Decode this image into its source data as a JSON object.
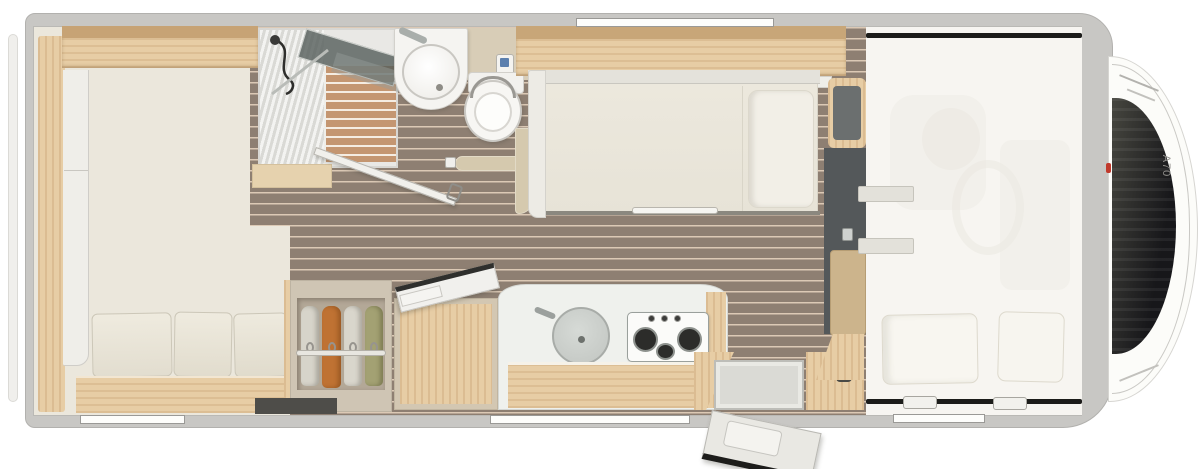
{
  "meta": {
    "title": "Motorhome floor plan, top view",
    "model_label": "A70"
  },
  "palette": {
    "background": "#ffffff",
    "wall_gray": "#c8c7c4",
    "floor_wood": "#8e7f72",
    "floor_cream": "#ebe7dc",
    "furniture_oak": "#e7cda5",
    "upholstery_cream": "#f1eee6",
    "accent_dark": "#1d1d1b",
    "dinette_slate": "#54585a",
    "clothes_orange": "#bf7233",
    "clothes_green": "#a3a173",
    "marker_red": "#c13a2c",
    "panel_screen_blue": "#5b7fae"
  },
  "rooms": {
    "rear_bedroom": {
      "name": "rear bedroom",
      "fixtures": [
        "side wardrobe",
        "overhead cabinet",
        "bed with three cushions"
      ]
    },
    "bathroom": {
      "name": "bathroom",
      "fixtures": [
        "shower cabin",
        "washbasin",
        "toilet",
        "open swing door",
        "partition wall"
      ]
    },
    "kitchen": {
      "name": "kitchen",
      "fixtures": [
        "hanging wardrobe with clothes",
        "fridge cabinet with open lid",
        "round sink",
        "3-burner gas hob",
        "counter"
      ]
    },
    "living": {
      "name": "living area",
      "fixtures": [
        "single bed",
        "dinette seats",
        "entry door open",
        "entry step"
      ]
    },
    "cab": {
      "name": "driver cab with alcove",
      "fixtures": [
        "overcab drop-down bed",
        "two pillows",
        "bed latches",
        "windshield"
      ],
      "model_label": "A70"
    }
  },
  "windows": {
    "top": 1,
    "bottom": 3
  }
}
